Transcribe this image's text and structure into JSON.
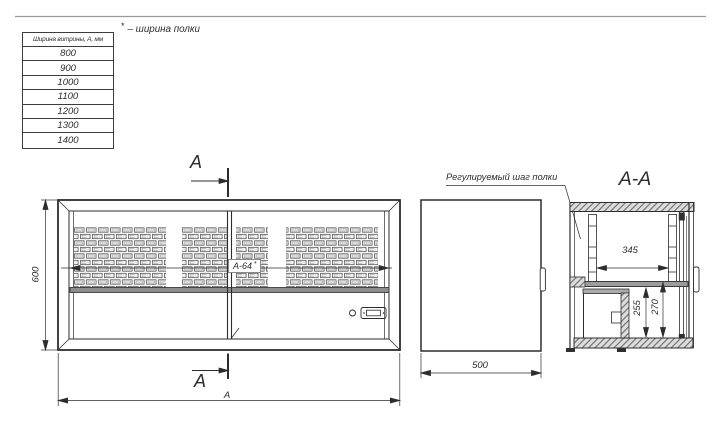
{
  "drawing": {
    "line_color": "#2d2d2d",
    "background": "#ffffff",
    "hatch_fill": "#dddddd"
  },
  "size_table": {
    "header": "Ширина витрины, А, мм",
    "rows": [
      "800",
      "900",
      "1000",
      "1100",
      "1200",
      "1300",
      "1400"
    ]
  },
  "footnote": {
    "marker": "*",
    "text": "– ширина полки"
  },
  "front_view": {
    "section_marker_top": "А",
    "section_marker_bottom": "А",
    "height_dim": "600",
    "width_dim": "А",
    "shelf_width_dim": "А-64",
    "shelf_width_marker": "*"
  },
  "side_view": {
    "depth_dim": "500"
  },
  "section_view": {
    "title": "А-А",
    "callout": "Регулируемый шаг полки",
    "rail_spacing_dim": "345",
    "clearance_dim": "255",
    "shelf_height_dim": "270"
  }
}
